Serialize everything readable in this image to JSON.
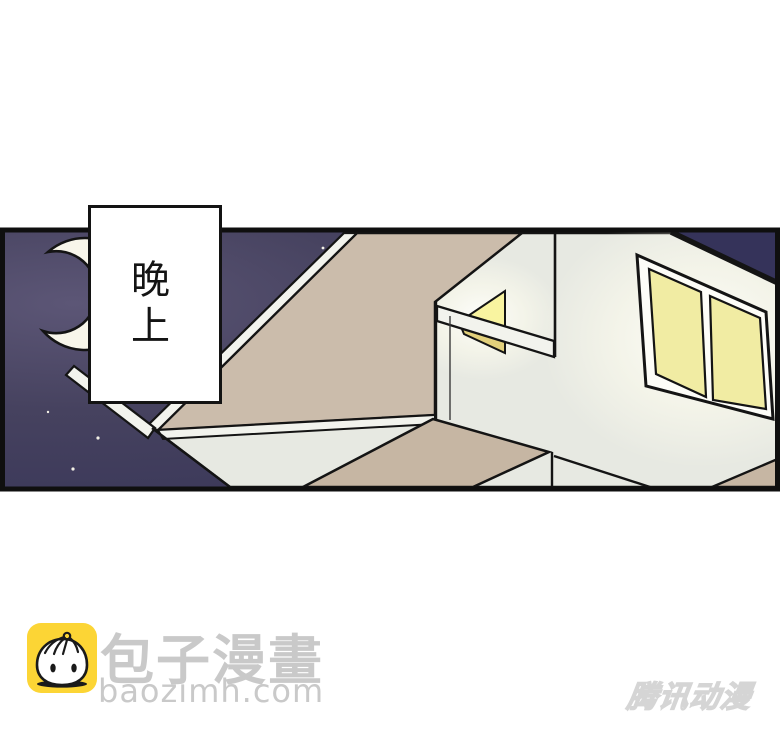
{
  "comic": {
    "caption": "晚上"
  },
  "footer": {
    "site_name": "包子漫畫",
    "site_url": "baozimh.com",
    "watermark": "腾讯动漫"
  },
  "colors": {
    "sky_dark": "#37345a",
    "sky_light": "#5c5676",
    "wall_white": "#e7e9e2",
    "soffit_beige": "#cbbcab",
    "lower_soffit_beige": "#c6b6a3",
    "window_yellow": "#f1eca3",
    "small_window_bright": "#f9f4a0",
    "small_window_dim": "#e2d07b",
    "moon_cream": "#f8f6ea",
    "logo_yellow": "#fcd535",
    "footer_text_gray": "#c9c9c9",
    "outline_black": "#141414"
  },
  "icons": {
    "moon": "crescent-moon",
    "logo": "baozi-bun-mascot"
  }
}
